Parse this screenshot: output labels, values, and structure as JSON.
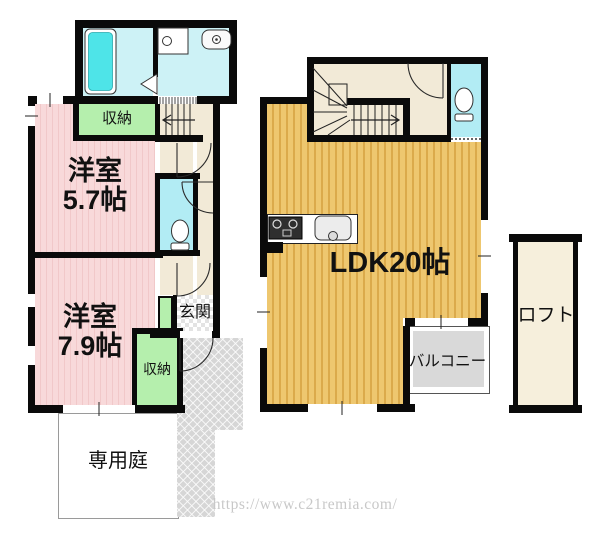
{
  "floor1": {
    "storage_upper": "収納",
    "bedroom_a": {
      "name": "洋室",
      "size": "5.7帖"
    },
    "bedroom_b": {
      "name": "洋室",
      "size": "7.9帖"
    },
    "entrance": "玄関",
    "storage_lower": "収納",
    "private_garden": "専用庭"
  },
  "floor2": {
    "ldk": "LDK20帖",
    "balcony": "バルコニー",
    "loft": "ロフト"
  },
  "watermark": "https://www.c21remia.com/",
  "icons": [
    "bathtub-icon",
    "washing-machine-icon",
    "wash-basin-icon",
    "toilet-icon-1f",
    "toilet-icon-2f",
    "stove-icon",
    "kitchen-sink-icon",
    "stair-arrow-up-icon",
    "stair-arrow-icon",
    "door-arc",
    "window-marker"
  ],
  "colors": {
    "wall": "#0a0a0a",
    "bedroom_pink": "#f8d9da",
    "bedroom_pink_stripe": "#f1c8c9",
    "storage_green": "#b5efad",
    "washroom_cyan": "#cdf2f6",
    "toilet_cyan": "#b2ecf4",
    "bathtub_cyan": "#4ee4e8",
    "hall_beige": "#f2ead7",
    "ldk_orange": "#eec76f",
    "ldk_orange_stripe": "#dbaa4b",
    "loft_cream": "#f6efdc",
    "balcony_gray": "#d9d9d9",
    "approach_gray": "#d6d6d6",
    "watermark_gray": "#c8c8c8"
  }
}
